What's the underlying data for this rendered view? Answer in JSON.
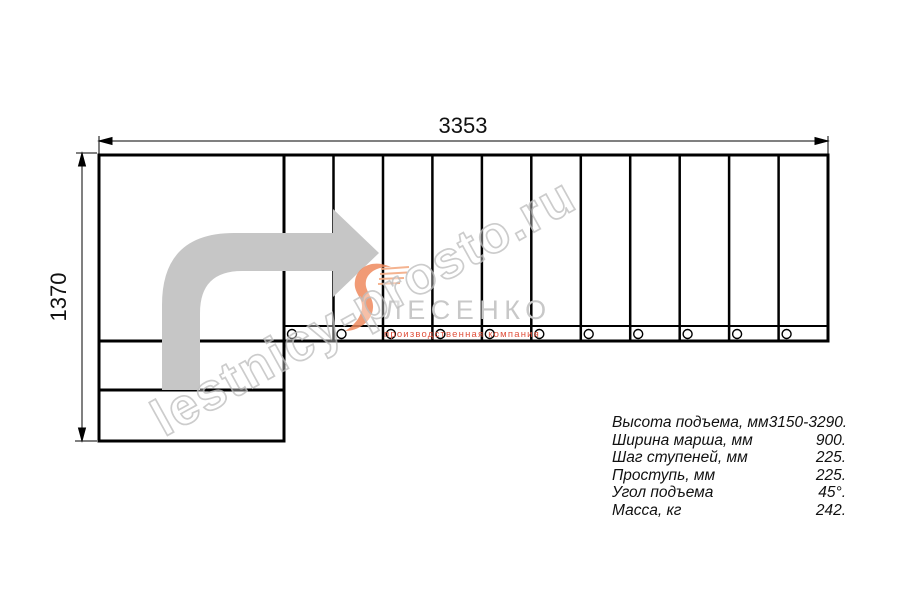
{
  "dimensions": {
    "top": "3353",
    "left": "1370"
  },
  "specs": {
    "rows": [
      {
        "label": "Высота подъема, мм",
        "value": "3150-3290."
      },
      {
        "label": "Ширина марша, мм",
        "value": "900."
      },
      {
        "label": "Шаг ступеней, мм",
        "value": "225."
      },
      {
        "label": "Проступь, мм",
        "value": "225."
      },
      {
        "label": "Угол подъема",
        "value": "45°."
      },
      {
        "label": "Масса, кг",
        "value": "242."
      }
    ]
  },
  "logo": {
    "name": "ЛЕСЕНКО",
    "tagline": "производственная компания"
  },
  "watermark": {
    "text": "lestnicy-prosto.ru"
  },
  "colors": {
    "line": "#000000",
    "arrow_gray": "#c6c6c6",
    "logo_orange": "#ef8a5e",
    "logo_text_gray": "#c8c8c8",
    "watermark_gray": "#c0c0c0"
  }
}
